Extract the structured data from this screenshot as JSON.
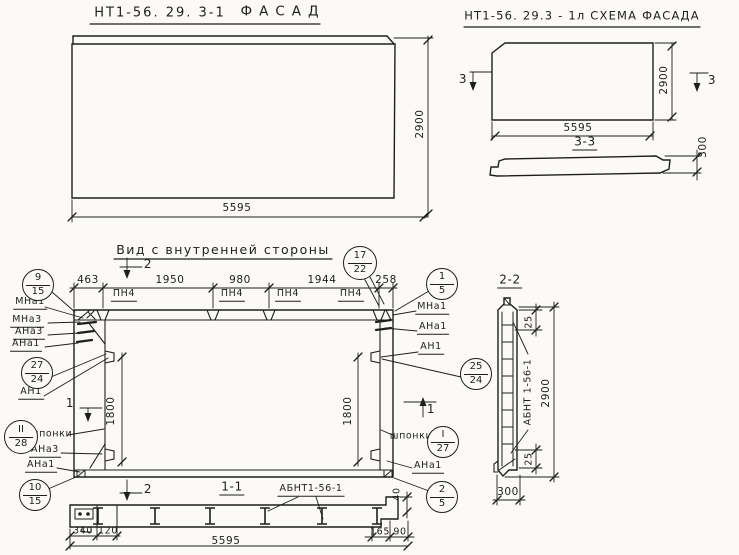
{
  "palette": {
    "paper": "#fbfaf6",
    "ink": "#1e1e1e"
  },
  "titles": {
    "facade_code": "НТ1-56. 29. 3-1",
    "facade": "ФАСАД",
    "scheme": "НТ1-56. 29.3 - 1л СХЕМА ФАСАДА",
    "interior": "Вид с внутренней стороны",
    "section11": "1-1",
    "section22": "2-2",
    "section33": "3-3"
  },
  "facade": {
    "width": "5595",
    "height": "2900"
  },
  "scheme": {
    "width": "5595",
    "height": "2900",
    "thickness": "300",
    "mark_left": "3",
    "mark_right": "3"
  },
  "interior": {
    "dims_top": [
      "463",
      "1950",
      "980",
      "1944",
      "258"
    ],
    "dim_left": "1800",
    "dim_right": "1800",
    "pn": [
      "ПН4",
      "ПН4",
      "ПН4",
      "ПН4"
    ],
    "labels_left": [
      "МНа1",
      "МНа3",
      "АНа3",
      "АНа1",
      "АН1",
      "шпонки",
      "АНа3",
      "АНа1"
    ],
    "labels_right": [
      "МНа1",
      "АНа1",
      "АН1",
      "шпонки",
      "АНа1"
    ],
    "marks": {
      "top": "2",
      "bottom": "2",
      "left": "1",
      "right": "1"
    }
  },
  "callouts": {
    "left": [
      {
        "t": "9",
        "b": "15"
      },
      {
        "t": "27",
        "b": "24"
      },
      {
        "t": "II",
        "b": "28"
      },
      {
        "t": "10",
        "b": "15"
      }
    ],
    "right": [
      {
        "t": "17",
        "b": "22"
      },
      {
        "t": "1",
        "b": "5"
      },
      {
        "t": "25",
        "b": "24"
      },
      {
        "t": "I",
        "b": "27"
      },
      {
        "t": "2",
        "b": "5"
      }
    ]
  },
  "section11": {
    "label": "АБНТ1-56-1",
    "dims": {
      "a": "340",
      "b": "120",
      "c": "5595",
      "d": "165",
      "e": "90",
      "f": "40"
    }
  },
  "section22": {
    "label": "АБНТ 1-56-1",
    "dim_top": "25",
    "dim_bottom": "25",
    "height": "2900",
    "width": "300"
  }
}
